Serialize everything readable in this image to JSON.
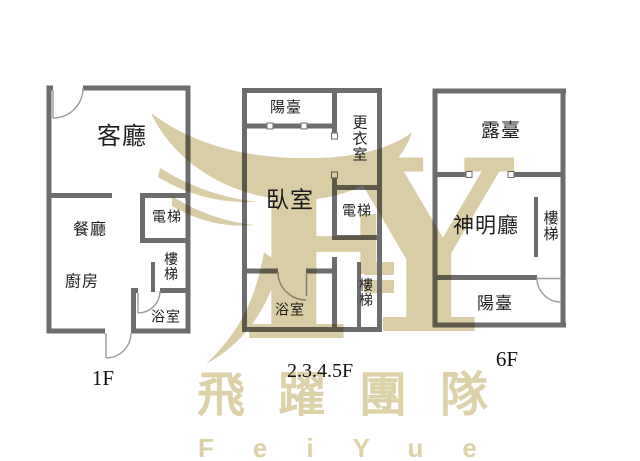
{
  "colors": {
    "wall": "#6d6d6d",
    "label_text": "#1f1f1f",
    "watermark_beige": "#d9cda6",
    "door_arc_gray": "#9b9b9b"
  },
  "floors": [
    {
      "label": "1F",
      "rooms": [
        {
          "name": "living-room",
          "label": "客廳"
        },
        {
          "name": "dining-room",
          "label": "餐廳"
        },
        {
          "name": "kitchen",
          "label": "廚房"
        },
        {
          "name": "elevator",
          "label": "電梯"
        },
        {
          "name": "stairs",
          "label": "樓梯"
        },
        {
          "name": "bathroom",
          "label": "浴室"
        }
      ]
    },
    {
      "label": "2.3.4.5F",
      "rooms": [
        {
          "name": "balcony",
          "label": "陽臺"
        },
        {
          "name": "walk-in-closet",
          "label": "更衣室"
        },
        {
          "name": "bedroom",
          "label": "臥室"
        },
        {
          "name": "elevator",
          "label": "電梯"
        },
        {
          "name": "stairs",
          "label": "樓梯"
        },
        {
          "name": "bathroom",
          "label": "浴室"
        }
      ]
    },
    {
      "label": "6F",
      "rooms": [
        {
          "name": "roof-terrace",
          "label": "露臺"
        },
        {
          "name": "shrine-hall",
          "label": "神明廳"
        },
        {
          "name": "stairs",
          "label": "樓梯"
        },
        {
          "name": "balcony",
          "label": "陽臺"
        }
      ]
    }
  ],
  "watermark": {
    "monogram_f": "F",
    "monogram_y": "Y"
  },
  "branding": {
    "team_name_zh": "飛躍團隊",
    "team_name_en": "FeiYue"
  }
}
